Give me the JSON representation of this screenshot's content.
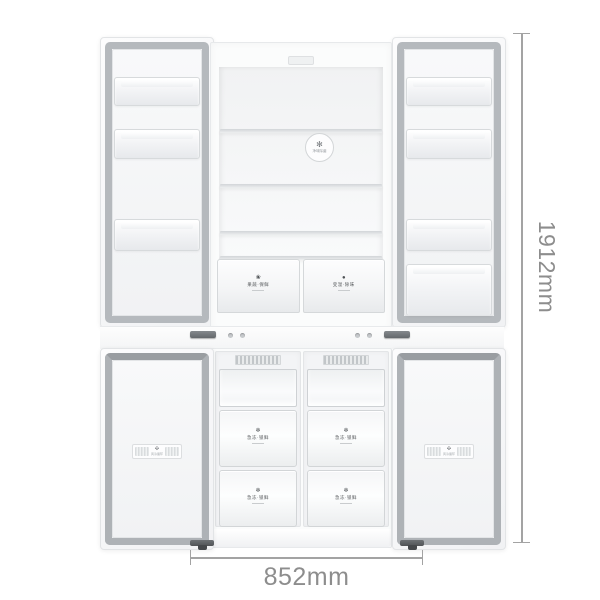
{
  "dimensions": {
    "height_label": "1912mm",
    "width_label": "852mm"
  },
  "colors": {
    "dimension_line": "#a3a3a3",
    "dimension_text": "#8d8d8d",
    "gasket_gray": "#b5b9bd",
    "hinge_gray": "#64686c",
    "body_white": "#ffffff"
  },
  "fridge": {
    "fan_badge": {
      "icon": "✻",
      "label": "净味除菌"
    },
    "crispers": [
      {
        "icon": "❀",
        "label": "果蔬·保鲜"
      },
      {
        "icon": "●",
        "label": "变温·除味"
      }
    ]
  },
  "freezer": {
    "drawers": [
      {
        "icon": "❄",
        "label": "急冻·锁鲜"
      },
      {
        "icon": "❄",
        "label": "急冻·锁鲜"
      },
      {
        "icon": "❄",
        "label": "急冻·锁鲜"
      },
      {
        "icon": "❄",
        "label": "急冻·锁鲜"
      }
    ]
  },
  "door_plaques": [
    {
      "icon": "✣",
      "label": "风冷循环"
    },
    {
      "icon": "✣",
      "label": "风冷循环"
    }
  ]
}
